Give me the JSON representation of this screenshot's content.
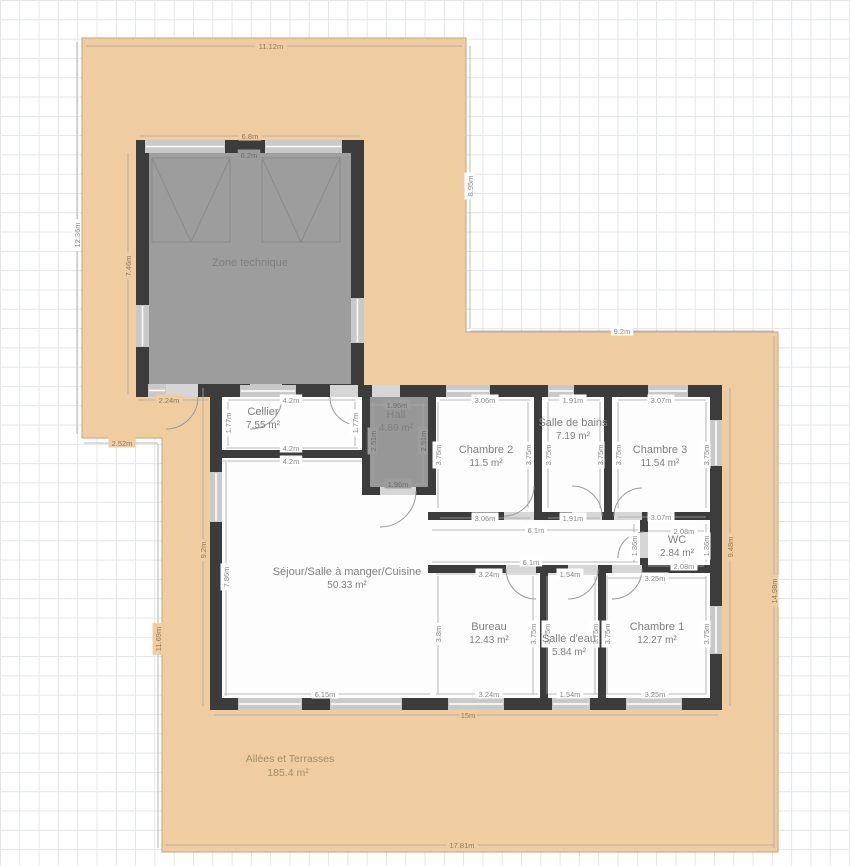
{
  "plan": {
    "colors": {
      "terrace_fill": "#f0cda1",
      "terrace_stroke": "#c8a472",
      "wall": "#3c3c3c",
      "window": "#c9c9c9",
      "opening": "#d6d6d6",
      "zone_fill": "#9d9d9d",
      "hall_fill": "#979797",
      "house_fill": "#fdfdfd",
      "dim_line": "#a6a6a6",
      "dim_text_white": "#8a8a8a",
      "dim_text_beige": "#8a7a5f",
      "dim_text_gray": "#6e6e6e",
      "room_text": "#7f7f7f",
      "terrace_text": "#a18d67",
      "door_arc": "#9a9a9a",
      "garage_line": "#8b8b8b"
    },
    "terrace": {
      "label": "Allées et Terrasses",
      "area": "185.4 m²",
      "polygon": "82,38 466,38 466,332 778,332 778,852 162,852 162,438 82,438",
      "lx": 290,
      "ly": 762
    },
    "house_rect": [
      210,
      385,
      512,
      325
    ],
    "rooms": [
      {
        "id": "zone-technique",
        "name": "Zone technique",
        "area": "",
        "nx": 250,
        "ny": 266,
        "fill": "#9d9d9d",
        "rect": [
          149,
          153,
          202,
          231
        ]
      },
      {
        "id": "hall",
        "name": "Hall",
        "area": "4.89 m²",
        "nx": 396,
        "ny": 418,
        "fill": "#979797",
        "rect": [
          370,
          397,
          58,
          90
        ]
      },
      {
        "id": "cellier",
        "name": "Cellier",
        "area": "7.55 m²",
        "nx": 263,
        "ny": 415
      },
      {
        "id": "chambre-2",
        "name": "Chambre 2",
        "area": "11.5 m²",
        "nx": 486,
        "ny": 453
      },
      {
        "id": "salle-de-bains",
        "name": "Salle de bains",
        "area": "7.19 m²",
        "nx": 573,
        "ny": 426
      },
      {
        "id": "chambre-3",
        "name": "Chambre 3",
        "area": "11.54 m²",
        "nx": 660,
        "ny": 453
      },
      {
        "id": "wc",
        "name": "WC",
        "area": "2.84 m²",
        "nx": 677,
        "ny": 543
      },
      {
        "id": "sejour",
        "name": "Séjour/Salle à manger/Cuisine",
        "area": "50.33 m²",
        "nx": 347,
        "ny": 575
      },
      {
        "id": "bureau",
        "name": "Bureau",
        "area": "12.43 m²",
        "nx": 489,
        "ny": 630
      },
      {
        "id": "salle-deau",
        "name": "Salle d'eau",
        "area": "5.84 m²",
        "nx": 569,
        "ny": 642
      },
      {
        "id": "chambre-1",
        "name": "Chambre 1",
        "area": "12.27 m²",
        "nx": 657,
        "ny": 630
      }
    ],
    "walls": [
      [
        136,
        140,
        228,
        13
      ],
      [
        136,
        140,
        13,
        257
      ],
      [
        351,
        140,
        13,
        257
      ],
      [
        136,
        384,
        228,
        13
      ],
      [
        210,
        385,
        512,
        12
      ],
      [
        210,
        698,
        512,
        12
      ],
      [
        210,
        385,
        12,
        325
      ],
      [
        710,
        385,
        12,
        325
      ],
      [
        222,
        450,
        148,
        8
      ],
      [
        362,
        397,
        8,
        98
      ],
      [
        428,
        397,
        8,
        98
      ],
      [
        362,
        487,
        74,
        8
      ],
      [
        534,
        397,
        8,
        123
      ],
      [
        604,
        397,
        8,
        123
      ],
      [
        428,
        512,
        294,
        8
      ],
      [
        640,
        520,
        8,
        53
      ],
      [
        428,
        565,
        294,
        8
      ],
      [
        540,
        573,
        8,
        125
      ],
      [
        598,
        573,
        8,
        125
      ]
    ],
    "openings": [
      [
        166,
        384,
        32,
        13
      ],
      [
        250,
        384,
        32,
        13
      ],
      [
        330,
        385,
        28,
        12
      ],
      [
        372,
        385,
        28,
        12
      ],
      [
        380,
        487,
        36,
        8
      ],
      [
        504,
        512,
        30,
        8
      ],
      [
        572,
        512,
        30,
        8
      ],
      [
        614,
        512,
        28,
        8
      ],
      [
        640,
        532,
        8,
        26
      ],
      [
        506,
        565,
        30,
        8
      ],
      [
        568,
        565,
        30,
        8
      ],
      [
        612,
        565,
        30,
        8
      ]
    ],
    "windows": [
      [
        145,
        140,
        80,
        13
      ],
      [
        265,
        140,
        77,
        13
      ],
      [
        136,
        305,
        13,
        42
      ],
      [
        351,
        298,
        13,
        45
      ],
      [
        148,
        384,
        18,
        13
      ],
      [
        250,
        384,
        32,
        13
      ],
      [
        240,
        385,
        56,
        12
      ],
      [
        446,
        385,
        44,
        12
      ],
      [
        548,
        385,
        26,
        12
      ],
      [
        648,
        385,
        40,
        12
      ],
      [
        210,
        472,
        12,
        50
      ],
      [
        238,
        698,
        64,
        12
      ],
      [
        330,
        698,
        72,
        12
      ],
      [
        448,
        698,
        56,
        12
      ],
      [
        552,
        698,
        38,
        12
      ],
      [
        626,
        698,
        56,
        12
      ],
      [
        710,
        420,
        12,
        46
      ],
      [
        710,
        606,
        12,
        48
      ]
    ],
    "doors": [
      "M198,397 A32,32 0 0 1 166,429",
      "M282,397 A32,32 0 0 1 250,429",
      "M330,397 A28,28 0 0 0 358,425",
      "M400,397 A28,28 0 0 1 372,425",
      "M416,491 A36,36 0 0 1 380,527",
      "M504,516 A30,30 0 0 0 534,486",
      "M602,516 A30,30 0 0 0 572,486",
      "M614,516 A28,28 0 0 1 642,488",
      "M644,532 A26,26 0 0 0 618,558",
      "M506,569 A30,30 0 0 0 536,599",
      "M598,569 A30,30 0 0 1 568,599",
      "M642,569 A30,30 0 0 1 612,599"
    ],
    "garage_doors": [
      {
        "rect": [
          152,
          158,
          78,
          84
        ],
        "v": [
          [
            152,
            158,
            191,
            242
          ],
          [
            230,
            158,
            191,
            242
          ]
        ]
      },
      {
        "rect": [
          262,
          158,
          78,
          84
        ],
        "v": [
          [
            262,
            158,
            301,
            242
          ],
          [
            340,
            158,
            301,
            242
          ]
        ]
      }
    ],
    "dim_lines": [
      [
        86,
        46,
        462,
        46
      ],
      [
        77,
        42,
        77,
        434
      ],
      [
        470,
        46,
        470,
        328
      ],
      [
        470,
        331,
        774,
        331
      ],
      [
        774,
        336,
        774,
        848
      ],
      [
        166,
        845,
        774,
        845
      ],
      [
        158,
        444,
        158,
        848
      ],
      [
        84,
        443,
        158,
        443
      ],
      [
        138,
        400,
        208,
        400
      ],
      [
        140,
        136,
        360,
        136
      ],
      [
        128,
        153,
        128,
        394
      ],
      [
        203,
        388,
        203,
        706
      ],
      [
        226,
        462,
        226,
        696
      ],
      [
        730,
        388,
        730,
        706
      ],
      [
        228,
        400,
        356,
        400
      ],
      [
        228,
        402,
        228,
        446
      ],
      [
        355,
        402,
        355,
        446
      ],
      [
        226,
        448,
        358,
        448
      ],
      [
        222,
        461,
        362,
        461
      ],
      [
        440,
        400,
        530,
        400
      ],
      [
        548,
        400,
        600,
        400
      ],
      [
        618,
        400,
        706,
        400
      ],
      [
        438,
        402,
        438,
        508
      ],
      [
        528,
        402,
        528,
        508
      ],
      [
        548,
        402,
        548,
        508
      ],
      [
        600,
        402,
        600,
        508
      ],
      [
        618,
        402,
        618,
        508
      ],
      [
        706,
        402,
        706,
        508
      ],
      [
        440,
        518,
        530,
        518
      ],
      [
        548,
        518,
        600,
        518
      ],
      [
        618,
        517,
        706,
        517
      ],
      [
        432,
        530,
        638,
        530
      ],
      [
        432,
        562,
        638,
        562
      ],
      [
        648,
        531,
        704,
        531
      ],
      [
        648,
        566,
        704,
        566
      ],
      [
        634,
        524,
        634,
        562
      ],
      [
        706,
        524,
        706,
        562
      ],
      [
        436,
        574,
        538,
        574
      ],
      [
        548,
        574,
        598,
        574
      ],
      [
        608,
        578,
        706,
        578
      ],
      [
        438,
        576,
        438,
        694
      ],
      [
        533,
        576,
        533,
        694
      ],
      [
        547,
        576,
        547,
        694
      ],
      [
        595,
        576,
        595,
        694
      ],
      [
        607,
        576,
        607,
        694
      ],
      [
        706,
        576,
        706,
        694
      ],
      [
        224,
        694,
        430,
        694
      ],
      [
        436,
        694,
        538,
        694
      ],
      [
        548,
        694,
        598,
        694
      ],
      [
        606,
        694,
        706,
        694
      ],
      [
        214,
        715,
        718,
        715
      ],
      [
        150,
        155,
        350,
        155
      ],
      [
        370,
        405,
        426,
        405
      ],
      [
        373,
        402,
        373,
        482
      ],
      [
        423,
        402,
        423,
        482
      ],
      [
        370,
        484,
        426,
        484
      ]
    ],
    "dim_labels": [
      {
        "t": "11.12m",
        "x": 271,
        "y": 46,
        "bg": "b"
      },
      {
        "t": "12.36m",
        "x": 77,
        "y": 235,
        "r": 1,
        "bg": "w"
      },
      {
        "t": "8.95m",
        "x": 470,
        "y": 186,
        "r": 1,
        "bg": "w"
      },
      {
        "t": "9.2m",
        "x": 622,
        "y": 331,
        "bg": "w"
      },
      {
        "t": "14.98m",
        "x": 774,
        "y": 591,
        "r": 1,
        "bg": "b"
      },
      {
        "t": "17.81m",
        "x": 462,
        "y": 845,
        "bg": "b"
      },
      {
        "t": "11.69m",
        "x": 158,
        "y": 639,
        "r": 1,
        "bg": "b"
      },
      {
        "t": "2.52m",
        "x": 122,
        "y": 443,
        "bg": "b"
      },
      {
        "t": "2.24m",
        "x": 169,
        "y": 400,
        "bg": "b"
      },
      {
        "t": "6.8m",
        "x": 250,
        "y": 136,
        "bg": "b"
      },
      {
        "t": "7.46m",
        "x": 128,
        "y": 266,
        "r": 1,
        "bg": "b"
      },
      {
        "t": "9.2m",
        "x": 203,
        "y": 550,
        "r": 1,
        "bg": "b"
      },
      {
        "t": "9.48m",
        "x": 730,
        "y": 547,
        "r": 1,
        "bg": "b"
      },
      {
        "t": "15m",
        "x": 468,
        "y": 715,
        "bg": "b"
      },
      {
        "t": "6.2m",
        "x": 249,
        "y": 155,
        "bg": "g"
      },
      {
        "t": "1.95m",
        "x": 397,
        "y": 405,
        "bg": "g"
      },
      {
        "t": "2.51m",
        "x": 373,
        "y": 441,
        "r": 1,
        "bg": "g"
      },
      {
        "t": "2.51m",
        "x": 423,
        "y": 441,
        "r": 1,
        "bg": "g"
      },
      {
        "t": "1.96m",
        "x": 398,
        "y": 484,
        "bg": "g"
      },
      {
        "t": "7.86m",
        "x": 226,
        "y": 577,
        "r": 1,
        "bg": "w"
      },
      {
        "t": "4.2m",
        "x": 291,
        "y": 400,
        "bg": "w"
      },
      {
        "t": "1.77m",
        "x": 228,
        "y": 423,
        "r": 1,
        "bg": "w"
      },
      {
        "t": "1.77m",
        "x": 355,
        "y": 423,
        "r": 1,
        "bg": "w"
      },
      {
        "t": "4.2m",
        "x": 291,
        "y": 448,
        "bg": "w"
      },
      {
        "t": "4.2m",
        "x": 291,
        "y": 461,
        "bg": "w"
      },
      {
        "t": "3.06m",
        "x": 485,
        "y": 400,
        "bg": "w"
      },
      {
        "t": "1.91m",
        "x": 573,
        "y": 400,
        "bg": "w"
      },
      {
        "t": "3.07m",
        "x": 661,
        "y": 400,
        "bg": "w"
      },
      {
        "t": "3.75m",
        "x": 438,
        "y": 455,
        "r": 1,
        "bg": "w"
      },
      {
        "t": "3.75m",
        "x": 528,
        "y": 455,
        "r": 1,
        "bg": "w"
      },
      {
        "t": "3.75m",
        "x": 548,
        "y": 455,
        "r": 1,
        "bg": "w"
      },
      {
        "t": "3.75m",
        "x": 600,
        "y": 455,
        "r": 1,
        "bg": "w"
      },
      {
        "t": "3.75m",
        "x": 618,
        "y": 455,
        "r": 1,
        "bg": "w"
      },
      {
        "t": "3.75m",
        "x": 706,
        "y": 455,
        "r": 1,
        "bg": "w"
      },
      {
        "t": "3.06m",
        "x": 485,
        "y": 518,
        "bg": "w"
      },
      {
        "t": "1.91m",
        "x": 573,
        "y": 518,
        "bg": "w"
      },
      {
        "t": "3.07m",
        "x": 661,
        "y": 517,
        "bg": "w"
      },
      {
        "t": "6.1m",
        "x": 536,
        "y": 530,
        "bg": "w"
      },
      {
        "t": "6.1m",
        "x": 531,
        "y": 562,
        "bg": "w"
      },
      {
        "t": "2.08m",
        "x": 684,
        "y": 531,
        "bg": "w"
      },
      {
        "t": "2.08m",
        "x": 684,
        "y": 566,
        "bg": "w"
      },
      {
        "t": "1.36m",
        "x": 634,
        "y": 546,
        "r": 1,
        "bg": "w"
      },
      {
        "t": "1.36m",
        "x": 706,
        "y": 546,
        "r": 1,
        "bg": "w"
      },
      {
        "t": "3.24m",
        "x": 489,
        "y": 574,
        "bg": "w"
      },
      {
        "t": "1.54m",
        "x": 570,
        "y": 574,
        "bg": "w"
      },
      {
        "t": "3.25m",
        "x": 655,
        "y": 578,
        "bg": "w"
      },
      {
        "t": "3.8m",
        "x": 438,
        "y": 634,
        "r": 1,
        "bg": "w"
      },
      {
        "t": "3.75m",
        "x": 533,
        "y": 634,
        "r": 1,
        "bg": "w"
      },
      {
        "t": "3.75m",
        "x": 547,
        "y": 634,
        "r": 1,
        "bg": "w"
      },
      {
        "t": "3.75m",
        "x": 595,
        "y": 634,
        "r": 1,
        "bg": "w"
      },
      {
        "t": "3.75m",
        "x": 607,
        "y": 634,
        "r": 1,
        "bg": "w"
      },
      {
        "t": "3.75m",
        "x": 706,
        "y": 634,
        "r": 1,
        "bg": "w"
      },
      {
        "t": "6.15m",
        "x": 325,
        "y": 694,
        "bg": "w"
      },
      {
        "t": "3.24m",
        "x": 489,
        "y": 694,
        "bg": "w"
      },
      {
        "t": "1.54m",
        "x": 570,
        "y": 694,
        "bg": "w"
      },
      {
        "t": "3.25m",
        "x": 655,
        "y": 694,
        "bg": "w"
      }
    ]
  }
}
